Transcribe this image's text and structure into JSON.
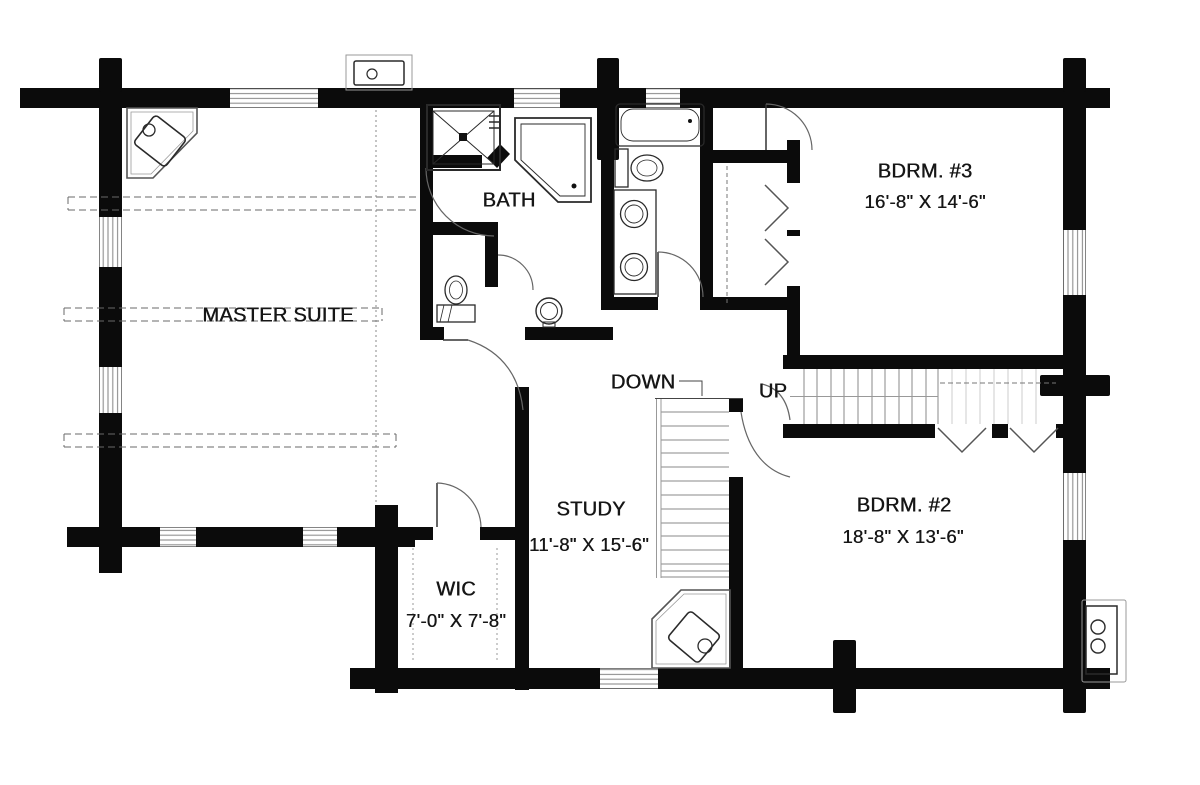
{
  "plan": {
    "type": "floor-plan",
    "colors": {
      "wall": "#0b0b0b",
      "line": "#666666",
      "background": "#ffffff",
      "text": "#161616"
    },
    "rooms": [
      {
        "id": "master-suite",
        "label": "MASTER SUITE",
        "dims": ""
      },
      {
        "id": "bath",
        "label": "BATH",
        "dims": ""
      },
      {
        "id": "bedroom-3",
        "label": "BDRM. #3",
        "dims": "16'-8\" X 14'-6\""
      },
      {
        "id": "bedroom-2",
        "label": "BDRM. #2",
        "dims": "18'-8\" X 13'-6\""
      },
      {
        "id": "study",
        "label": "STUDY",
        "dims": "11'-8\" X 15'-6\""
      },
      {
        "id": "wic",
        "label": "WIC",
        "dims": "7'-0\" X 7'-8\""
      }
    ],
    "stairs": {
      "down_label": "DOWN",
      "up_label": "UP"
    },
    "fixtures": [
      "shower",
      "corner-tub",
      "toilet",
      "pedestal-sink",
      "bathtub",
      "double-vanity",
      "wood-stove",
      "wood-stove-hearth",
      "exterior-sink",
      "utility-unit",
      "closet-rod",
      "bifold-door",
      "window",
      "log-wall-end"
    ]
  }
}
